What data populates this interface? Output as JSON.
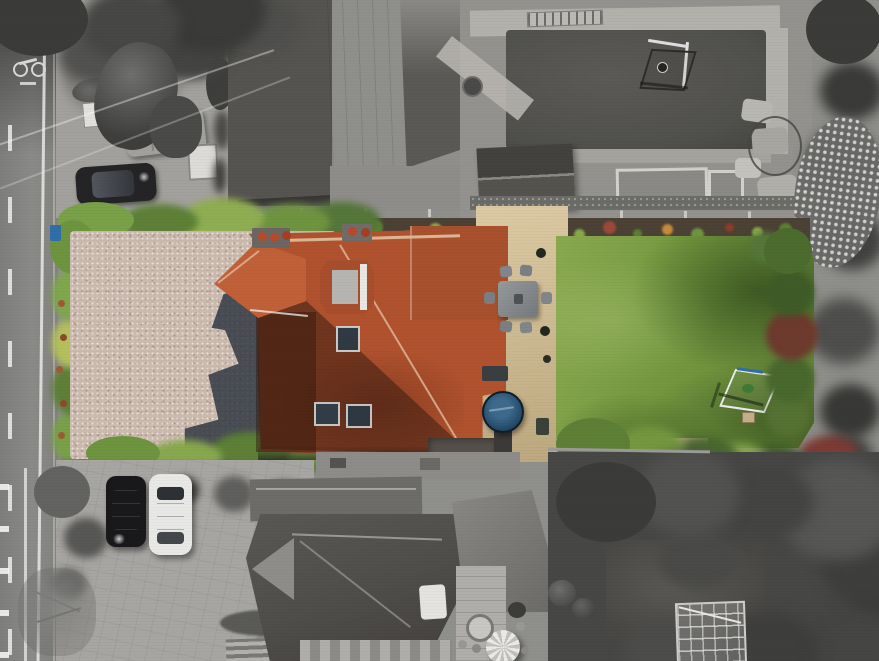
{
  "image_type": "aerial-drone-photograph",
  "style": "selective-colour estate-agent photo: subject property shown in colour, all surroundings desaturated to black-and-white",
  "palette": {
    "base_gray": "#8f8f8c",
    "road_gray": "#8a8a88",
    "road_shadow": "#454545",
    "line_white": "#ececec",
    "concrete": "#a3a19d",
    "pave_light": "#b3b1ac",
    "pave_mid": "#94928e",
    "roof_slate_dark": "#4b4b49",
    "roof_slate_mid": "#565450",
    "roof_slate_light": "#8f8d89",
    "flat_roof_light": "#cdcbc7",
    "tree_dark": "#3b3b39",
    "tree_mid": "#525250",
    "blossom_gray": "#d8d8d6",
    "neighbour_lawn_gray": "#50504c",
    "gravel_pink": "#cbbaae",
    "hedge_green": "#79a148",
    "hedge_dark": "#4c6c2e",
    "hedge_yellow": "#b5c05c",
    "lawn_green": "#74983f",
    "lawn_light": "#8aa94e",
    "lawn_shadow": "#2e4419",
    "roof_red": "#b0522e",
    "roof_red_bright": "#c06038",
    "roof_brown_dark": "#53301f",
    "ridge_light": "#dcb796",
    "patio_sand": "#c9b68e",
    "patio_sand_light": "#dccaa4",
    "hot_tub_blue": "#27506e",
    "hot_tub_rim": "#3d6a8c",
    "furniture_gray": "#82858a",
    "goal_white": "#ececec",
    "car_black": "#19191b",
    "car_white": "#e8e8e6",
    "house_shadow": "#2c3440",
    "soil_dark": "#4b4134",
    "flower_red": "#8c3c2d",
    "flower_yellow": "#c3bd4e",
    "flower_purple": "#7c4a63",
    "bin_blue": "#2f6ea8",
    "wall_tan": "#c2ae8c",
    "chimney_pot_red": "#b8492a"
  },
  "scene": {
    "subject_property_in_colour": {
      "house": "detached house, red clay tile hipped roofs, dark ribbed west slope, hipped dormer with grey flat top and white edge strips, two chimney stacks with red pots, three roof windows",
      "driveway": "pink-beige gravel forecourt bordered by green hedges, long house shadow cast across it, blue wheelie bin by road hedge",
      "patio": "sandstone flagstone terrace with grey six-seat dining set, dark mat, circular blue hot tub, dark planters and green bin",
      "garden": "large green lawn, tree shadows on right side, white-framed football goal with blue top bar, small tan patch, colourful shrub border along top fence, dark green and copper hedge on right, trees along bottom, low tan stone wall"
    },
    "surroundings_grayscale": {
      "road_left": "vertical road, solid and dashed white lane lines, painted cycle-lane symbol, tree shadows, white kerb dashes at bottom",
      "top_left": "courtyard parking: sheds and bins, white trailer bench, log pile, white panel, grey van, dark hatchback, white box trailer, overhanging trees and conifer, two overhead wires",
      "top_centre": "large building with dark pitched tile roofs, pale concrete flat roof strip, small skylight",
      "top_right": "neighbour rear garden: brick paver surround, dark lawn with football goal and ball, aluminium ladder, dark-roof shed, gravel planters with white edging, rockery stones, tree belt and white blossom tree on right edge",
      "bottom_left": "neighbour block-paved drive with black car and white car parked side by side, grey shrubs, bare tree, steps",
      "bottom_centre": "neighbour house with grey slate hipped roofs, light gable, chimney, white parasol on paved courtyard, round table and chairs, striped paving at bottom edge",
      "bottom_right": "dense tree canopy, darker clipped lawn, glass greenhouse, clipped hedge balls"
    }
  }
}
